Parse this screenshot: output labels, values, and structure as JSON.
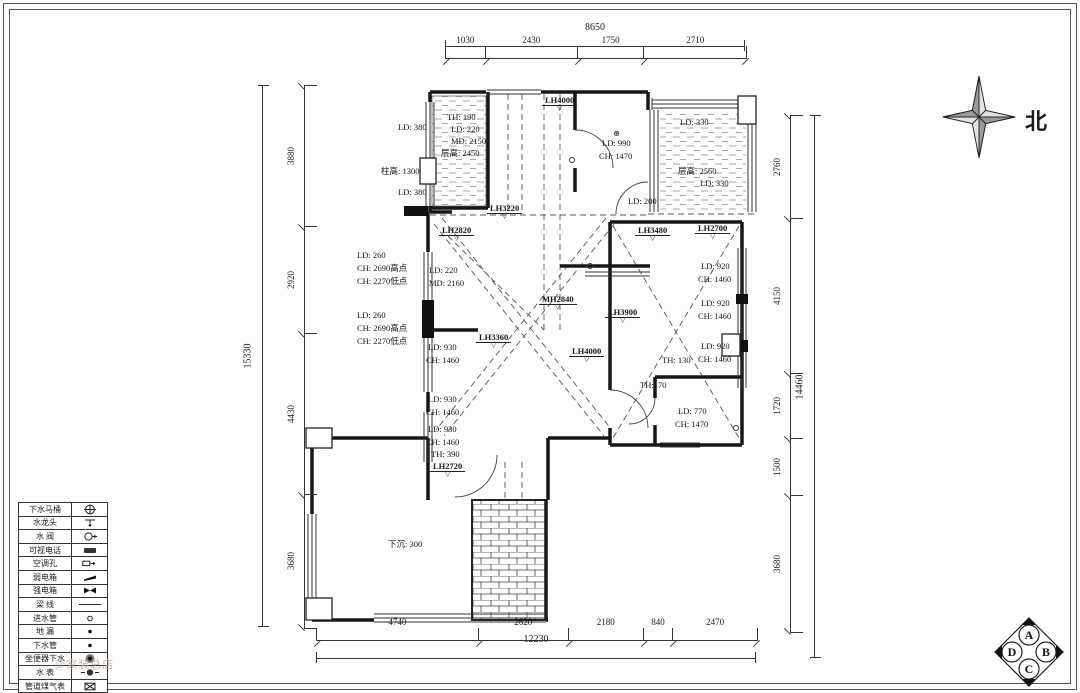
{
  "compass": {
    "north_label": "北"
  },
  "section_marker": {
    "top": "A",
    "right": "B",
    "bottom": "C",
    "left": "D"
  },
  "watermark": "@家装总店",
  "dimensions": {
    "top": {
      "total": "8650",
      "segments": [
        "1030",
        "2430",
        "1750",
        "2710"
      ]
    },
    "bottom": {
      "total": "12230",
      "segments": [
        "4740",
        "2620",
        "2180",
        "840",
        "2470"
      ]
    },
    "left": {
      "total": "15330",
      "segments": [
        "3880",
        "2920",
        "4430",
        "3680"
      ]
    },
    "right": {
      "total": "14460",
      "segments": [
        "2760",
        "4150",
        "1720",
        "1500",
        "3680"
      ]
    }
  },
  "plan_labels": [
    {
      "text": "LD: 380",
      "x": 398,
      "y": 122
    },
    {
      "text": "柱高: 1300",
      "x": 381,
      "y": 166
    },
    {
      "text": "LD: 380",
      "x": 398,
      "y": 187
    },
    {
      "text": "TH: 190",
      "x": 447,
      "y": 112
    },
    {
      "text": "LD: 220",
      "x": 451,
      "y": 124
    },
    {
      "text": "MD: 2150",
      "x": 451,
      "y": 136
    },
    {
      "text": "层高: 2450",
      "x": 441,
      "y": 148
    },
    {
      "text": "LH4000",
      "x": 542,
      "y": 95,
      "flag": true
    },
    {
      "text": "⊛",
      "x": 613,
      "y": 128
    },
    {
      "text": "LD: 990",
      "x": 602,
      "y": 138
    },
    {
      "text": "CH: 1470",
      "x": 599,
      "y": 151
    },
    {
      "text": "LD: 330",
      "x": 680,
      "y": 117
    },
    {
      "text": "层高: 2560",
      "x": 678,
      "y": 166
    },
    {
      "text": "LD: 330",
      "x": 700,
      "y": 178
    },
    {
      "text": "LD: 200",
      "x": 628,
      "y": 196
    },
    {
      "text": "LH3220",
      "x": 487,
      "y": 203,
      "flag": true
    },
    {
      "text": "LH2820",
      "x": 439,
      "y": 225,
      "flag": true
    },
    {
      "text": "LD: 260",
      "x": 357,
      "y": 250
    },
    {
      "text": "CH: 2690高点",
      "x": 357,
      "y": 263
    },
    {
      "text": "CH: 2270低点",
      "x": 357,
      "y": 276
    },
    {
      "text": "LD: 220",
      "x": 429,
      "y": 265
    },
    {
      "text": "MD: 2160",
      "x": 429,
      "y": 278
    },
    {
      "text": "LH3480",
      "x": 635,
      "y": 225,
      "flag": true
    },
    {
      "text": "LH2700",
      "x": 695,
      "y": 223,
      "flag": true
    },
    {
      "text": "LD: 920",
      "x": 701,
      "y": 261
    },
    {
      "text": "CH: 1460",
      "x": 698,
      "y": 274
    },
    {
      "text": "MH2840",
      "x": 539,
      "y": 294,
      "flag": true
    },
    {
      "text": "LD: 920",
      "x": 701,
      "y": 298
    },
    {
      "text": "CH: 1460",
      "x": 698,
      "y": 311
    },
    {
      "text": "LH3900",
      "x": 605,
      "y": 307,
      "flag": true
    },
    {
      "text": "LD: 260",
      "x": 357,
      "y": 310
    },
    {
      "text": "CH: 2690高点",
      "x": 357,
      "y": 323
    },
    {
      "text": "CH: 2270低点",
      "x": 357,
      "y": 336
    },
    {
      "text": "LH3360",
      "x": 476,
      "y": 332,
      "flag": true
    },
    {
      "text": "LD: 930",
      "x": 428,
      "y": 342
    },
    {
      "text": "CH: 1460",
      "x": 426,
      "y": 355
    },
    {
      "text": "LH4000",
      "x": 569,
      "y": 346,
      "flag": true
    },
    {
      "text": "LD: 920",
      "x": 701,
      "y": 341
    },
    {
      "text": "CH: 1460",
      "x": 698,
      "y": 354
    },
    {
      "text": "TH: 130",
      "x": 662,
      "y": 355
    },
    {
      "text": "TH:170",
      "x": 640,
      "y": 380
    },
    {
      "text": "LD: 930",
      "x": 428,
      "y": 394
    },
    {
      "text": "CH: 1460",
      "x": 426,
      "y": 407
    },
    {
      "text": "LD: 770",
      "x": 678,
      "y": 406
    },
    {
      "text": "CH: 1470",
      "x": 675,
      "y": 419
    },
    {
      "text": "LD: 930",
      "x": 428,
      "y": 424
    },
    {
      "text": "CH: 1460",
      "x": 426,
      "y": 437
    },
    {
      "text": "TH: 390",
      "x": 431,
      "y": 449
    },
    {
      "text": "LH2720",
      "x": 430,
      "y": 461,
      "flag": true
    },
    {
      "text": "下沉: 300",
      "x": 388,
      "y": 539
    }
  ],
  "legend": {
    "rows": [
      {
        "label": "下水马桶",
        "symbol": "toilet-drain"
      },
      {
        "label": "水龙头",
        "symbol": "faucet"
      },
      {
        "label": "水 阀",
        "symbol": "valve"
      },
      {
        "label": "可视电话",
        "symbol": "videophone"
      },
      {
        "label": "空调孔",
        "symbol": "ac-hole"
      },
      {
        "label": "弱电箱",
        "symbol": "weak-box"
      },
      {
        "label": "强电箱",
        "symbol": "strong-box"
      },
      {
        "label": "梁 线",
        "symbol": "beam-line"
      },
      {
        "label": "进水管",
        "symbol": "inlet-pipe"
      },
      {
        "label": "地 漏",
        "symbol": "floor-drain"
      },
      {
        "label": "下水管",
        "symbol": "drain-pipe"
      },
      {
        "label": "坐便器下水",
        "symbol": "toilet-outlet"
      },
      {
        "label": "水 表",
        "symbol": "water-meter"
      },
      {
        "label": "管道煤气表",
        "symbol": "gas-meter"
      }
    ]
  }
}
